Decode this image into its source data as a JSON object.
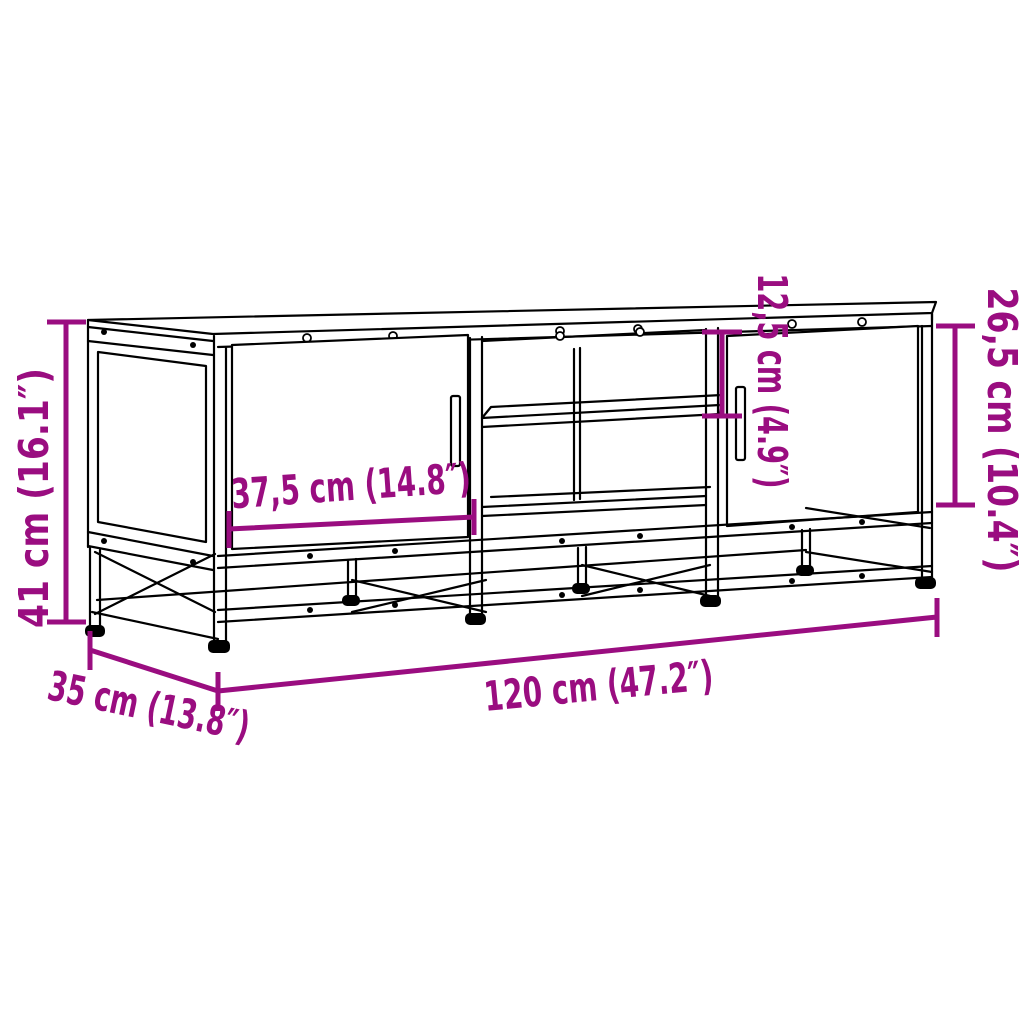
{
  "figure": {
    "type": "product-dimension-diagram",
    "subject": "TV stand with two doors and open middle shelf",
    "background_color": "#ffffff",
    "line_color": "#000000",
    "accent_color": "#9A0D80"
  },
  "dimensions": {
    "overall_height": "41 cm (16.1″)",
    "overall_depth": "35 cm (13.8″)",
    "overall_width": "120 cm (47.2″)",
    "door_width": "37,5 cm (14.8″)",
    "shelf_opening_height": "12,5 cm (4.9″)",
    "door_height": "26,5 cm (10.4″)"
  }
}
